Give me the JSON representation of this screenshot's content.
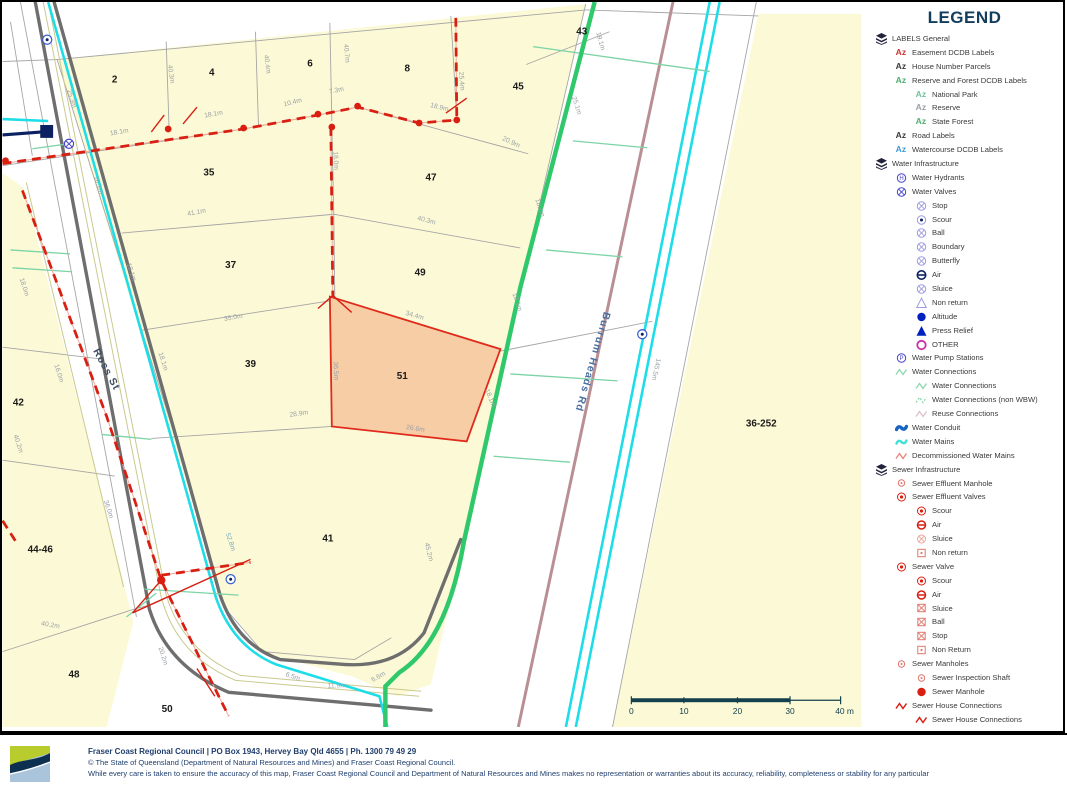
{
  "colors": {
    "parcel_fill": "#FCFAD6",
    "selected_parcel_fill": "#F6C9A2",
    "selected_parcel_border": "#E02A1C",
    "road_casing": "#6E6E6E",
    "water_main_cyan": "#1CDDE8",
    "water_green": "#2FC96B",
    "decom_brown": "#B98F93",
    "sewer_red": "#D81F12",
    "conduit_navy": "#0B2161",
    "valve_blue": "#4646C8",
    "valve_blue_light": "#9C9CE0",
    "magenta": "#CC2FA8",
    "dim_gray": "#9AA0A6",
    "scale_teal": "#15404D",
    "legend_title": "#123D5C",
    "footer_navy": "#1F3E6E"
  },
  "legend": {
    "title": "LEGEND",
    "items": [
      {
        "label": "LABELS General",
        "indent": 0,
        "icon": "layers-icon"
      },
      {
        "label": "Easement DCDB Labels",
        "indent": 1,
        "icon": "az-red-icon"
      },
      {
        "label": "House Number Parcels",
        "indent": 1,
        "icon": "az-dark-icon"
      },
      {
        "label": "Reserve and Forest DCDB Labels",
        "indent": 1,
        "icon": "az-green-icon"
      },
      {
        "label": "National Park",
        "indent": 2,
        "icon": "az-teal-icon"
      },
      {
        "label": "Reserve",
        "indent": 2,
        "icon": "az-gray-icon"
      },
      {
        "label": "State Forest",
        "indent": 2,
        "icon": "az-green-icon"
      },
      {
        "label": "Road Labels",
        "indent": 1,
        "icon": "az-dark-icon"
      },
      {
        "label": "Watercourse DCDB Labels",
        "indent": 1,
        "icon": "az-blue-icon"
      },
      {
        "label": "Water Infrastructure",
        "indent": 0,
        "icon": "layers-icon"
      },
      {
        "label": "Water Hydrants",
        "indent": 1,
        "icon": "circle-h-blue-icon"
      },
      {
        "label": "Water Valves",
        "indent": 1,
        "icon": "circle-x-blue-icon"
      },
      {
        "label": "Stop",
        "indent": 2,
        "icon": "circle-x-lightblue-icon"
      },
      {
        "label": "Scour",
        "indent": 2,
        "icon": "circle-dot-blue-icon"
      },
      {
        "label": "Ball",
        "indent": 2,
        "icon": "circle-x-lightblue-icon"
      },
      {
        "label": "Boundary",
        "indent": 2,
        "icon": "circle-x-lightblue-icon"
      },
      {
        "label": "Butterfly",
        "indent": 2,
        "icon": "circle-x-lightblue-icon"
      },
      {
        "label": "Air",
        "indent": 2,
        "icon": "circle-hbar-blue-icon"
      },
      {
        "label": "Sluice",
        "indent": 2,
        "icon": "circle-x-lightblue-icon"
      },
      {
        "label": "Non return",
        "indent": 2,
        "icon": "triangle-outline-icon"
      },
      {
        "label": "Altitude",
        "indent": 2,
        "icon": "circle-filled-blue-icon"
      },
      {
        "label": "Press Relief",
        "indent": 2,
        "icon": "triangle-filled-blue-icon"
      },
      {
        "label": "OTHER",
        "indent": 2,
        "icon": "circle-magenta-icon"
      },
      {
        "label": "Water Pump Stations",
        "indent": 1,
        "icon": "circle-p-blue-icon"
      },
      {
        "label": "Water Connections",
        "indent": 1,
        "icon": "zigzag-green-icon"
      },
      {
        "label": "Water Connections",
        "indent": 2,
        "icon": "zigzag-green-icon"
      },
      {
        "label": "Water Connections (non WBW)",
        "indent": 2,
        "icon": "zigzag-green-dashed-icon"
      },
      {
        "label": "Reuse Connections",
        "indent": 2,
        "icon": "zigzag-pink-icon"
      },
      {
        "label": "Water Conduit",
        "indent": 1,
        "icon": "wave-navy-icon"
      },
      {
        "label": "Water Mains",
        "indent": 1,
        "icon": "wave-cyan-icon"
      },
      {
        "label": "Decommissioned Water Mains",
        "indent": 1,
        "icon": "zigzag-salmon-icon"
      },
      {
        "label": "Sewer Infrastructure",
        "indent": 0,
        "icon": "layers-icon"
      },
      {
        "label": "Sewer Effluent Manhole",
        "indent": 1,
        "icon": "circle-dot-red-small-icon"
      },
      {
        "label": "Sewer Effluent Valves",
        "indent": 1,
        "icon": "circle-dot-red-icon"
      },
      {
        "label": "Scour",
        "indent": 2,
        "icon": "circle-dot-red-icon"
      },
      {
        "label": "Air",
        "indent": 2,
        "icon": "circle-hbar-red-icon"
      },
      {
        "label": "Sluice",
        "indent": 2,
        "icon": "circle-x-lightred-icon"
      },
      {
        "label": "Non return",
        "indent": 2,
        "icon": "square-dot-red-icon"
      },
      {
        "label": "Sewer Valve",
        "indent": 1,
        "icon": "circle-dot-red-icon"
      },
      {
        "label": "Scour",
        "indent": 2,
        "icon": "circle-dot-red-icon"
      },
      {
        "label": "Air",
        "indent": 2,
        "icon": "circle-hbar-red-icon"
      },
      {
        "label": "Sluice",
        "indent": 2,
        "icon": "square-x-red-icon"
      },
      {
        "label": "Ball",
        "indent": 2,
        "icon": "square-x-red-icon"
      },
      {
        "label": "Stop",
        "indent": 2,
        "icon": "square-x-red-icon"
      },
      {
        "label": "Non Return",
        "indent": 2,
        "icon": "square-dot-red-icon"
      },
      {
        "label": "Sewer Manholes",
        "indent": 1,
        "icon": "circle-dot-red-small-icon"
      },
      {
        "label": "Sewer Inspection Shaft",
        "indent": 2,
        "icon": "circle-dot-red-small-icon"
      },
      {
        "label": "Sewer Manhole",
        "indent": 2,
        "icon": "circle-filled-red-icon"
      },
      {
        "label": "Sewer House Connections",
        "indent": 1,
        "icon": "zigzag-red-icon"
      },
      {
        "label": "Sewer House Connections",
        "indent": 2,
        "icon": "zigzag-red-icon"
      }
    ]
  },
  "map": {
    "selected_parcel": "51",
    "labels": [
      {
        "t": "2",
        "x": 113,
        "y": 81,
        "r": 0,
        "k": "p"
      },
      {
        "t": "4",
        "x": 211,
        "y": 74,
        "r": 0,
        "k": "p"
      },
      {
        "t": "6",
        "x": 310,
        "y": 65,
        "r": 0,
        "k": "p"
      },
      {
        "t": "8",
        "x": 408,
        "y": 70,
        "r": 0,
        "k": "p"
      },
      {
        "t": "45",
        "x": 520,
        "y": 88,
        "r": 0,
        "k": "p"
      },
      {
        "t": "43",
        "x": 584,
        "y": 33,
        "r": 0,
        "k": "p"
      },
      {
        "t": "35",
        "x": 208,
        "y": 175,
        "r": 0,
        "k": "p"
      },
      {
        "t": "47",
        "x": 432,
        "y": 180,
        "r": 0,
        "k": "p"
      },
      {
        "t": "37",
        "x": 230,
        "y": 268,
        "r": 0,
        "k": "p"
      },
      {
        "t": "49",
        "x": 421,
        "y": 276,
        "r": 0,
        "k": "p"
      },
      {
        "t": "39",
        "x": 250,
        "y": 368,
        "r": 0,
        "k": "p"
      },
      {
        "t": "51",
        "x": 403,
        "y": 380,
        "r": 0,
        "k": "p"
      },
      {
        "t": "41",
        "x": 328,
        "y": 544,
        "r": 0,
        "k": "p"
      },
      {
        "t": "42",
        "x": 16,
        "y": 407,
        "r": 0,
        "k": "p"
      },
      {
        "t": "44-46",
        "x": 38,
        "y": 555,
        "r": 0,
        "k": "p"
      },
      {
        "t": "48",
        "x": 72,
        "y": 681,
        "r": 0,
        "k": "p"
      },
      {
        "t": "50",
        "x": 166,
        "y": 716,
        "r": 0,
        "k": "p"
      },
      {
        "t": "36-252",
        "x": 765,
        "y": 428,
        "r": 0,
        "k": "p"
      },
      {
        "t": "Ross St",
        "x": 102,
        "y": 372,
        "r": 62,
        "k": "road"
      },
      {
        "t": "Burrum Heads Rd",
        "x": 592,
        "y": 362,
        "r": 106,
        "k": "road2"
      },
      {
        "t": "25.3m",
        "x": 68,
        "y": 98,
        "r": 72,
        "k": "d"
      },
      {
        "t": "18.1m",
        "x": 95,
        "y": 185,
        "r": 72,
        "k": "d"
      },
      {
        "t": "18.1m",
        "x": 118,
        "y": 133,
        "r": -10,
        "k": "d"
      },
      {
        "t": "18.1m",
        "x": 213,
        "y": 115,
        "r": -10,
        "k": "d"
      },
      {
        "t": "40.3m",
        "x": 168,
        "y": 73,
        "r": 82,
        "k": "d"
      },
      {
        "t": "40.4m",
        "x": 265,
        "y": 63,
        "r": 83,
        "k": "d"
      },
      {
        "t": "40.7m",
        "x": 345,
        "y": 52,
        "r": 85,
        "k": "d"
      },
      {
        "t": "10.4m",
        "x": 293,
        "y": 103,
        "r": -14,
        "k": "d"
      },
      {
        "t": "7.3m",
        "x": 337,
        "y": 91,
        "r": -12,
        "k": "d"
      },
      {
        "t": "18.9m",
        "x": 440,
        "y": 108,
        "r": 14,
        "k": "d"
      },
      {
        "t": "25.4m",
        "x": 461,
        "y": 80,
        "r": 86,
        "k": "d"
      },
      {
        "t": "20.9m",
        "x": 512,
        "y": 143,
        "r": 25,
        "k": "d"
      },
      {
        "t": "19.1m",
        "x": 601,
        "y": 40,
        "r": 75,
        "k": "d"
      },
      {
        "t": "25.1m",
        "x": 577,
        "y": 105,
        "r": 72,
        "k": "d"
      },
      {
        "t": "18.1m",
        "x": 540,
        "y": 208,
        "r": 72,
        "k": "d"
      },
      {
        "t": "41.1m",
        "x": 196,
        "y": 214,
        "r": -11,
        "k": "d"
      },
      {
        "t": "40.3m",
        "x": 427,
        "y": 222,
        "r": 15,
        "k": "d"
      },
      {
        "t": "18.0m",
        "x": 334,
        "y": 160,
        "r": 88,
        "k": "d"
      },
      {
        "t": "18.0m",
        "x": 20,
        "y": 288,
        "r": 72,
        "k": "d"
      },
      {
        "t": "18.1m",
        "x": 128,
        "y": 273,
        "r": 72,
        "k": "d"
      },
      {
        "t": "16.0m",
        "x": 55,
        "y": 375,
        "r": 72,
        "k": "d"
      },
      {
        "t": "18.1m",
        "x": 160,
        "y": 363,
        "r": 72,
        "k": "d"
      },
      {
        "t": "35.0m",
        "x": 233,
        "y": 320,
        "r": -10,
        "k": "d"
      },
      {
        "t": "34.4m",
        "x": 415,
        "y": 318,
        "r": 16,
        "k": "d"
      },
      {
        "t": "36.5m",
        "x": 334,
        "y": 372,
        "r": 88,
        "k": "d"
      },
      {
        "t": "18.1m",
        "x": 517,
        "y": 303,
        "r": 72,
        "k": "d"
      },
      {
        "t": "18.1m",
        "x": 490,
        "y": 400,
        "r": 68,
        "k": "d"
      },
      {
        "t": "28.9m",
        "x": 299,
        "y": 417,
        "r": -8,
        "k": "d"
      },
      {
        "t": "26.6m",
        "x": 416,
        "y": 432,
        "r": 9,
        "k": "d"
      },
      {
        "t": "40.2m",
        "x": 14,
        "y": 446,
        "r": 72,
        "k": "d"
      },
      {
        "t": "36.0m",
        "x": 105,
        "y": 512,
        "r": 72,
        "k": "d"
      },
      {
        "t": "52.8m",
        "x": 228,
        "y": 545,
        "r": 72,
        "k": "db"
      },
      {
        "t": "40.2m",
        "x": 48,
        "y": 630,
        "r": 10,
        "k": "d"
      },
      {
        "t": "20.2m",
        "x": 160,
        "y": 660,
        "r": 72,
        "k": "d"
      },
      {
        "t": "45.2m",
        "x": 428,
        "y": 555,
        "r": 76,
        "k": "d"
      },
      {
        "t": "6.5m",
        "x": 292,
        "y": 682,
        "r": 20,
        "k": "d"
      },
      {
        "t": "11.9m",
        "x": 337,
        "y": 691,
        "r": 0,
        "k": "d"
      },
      {
        "t": "6.6m",
        "x": 380,
        "y": 682,
        "r": -30,
        "k": "d"
      },
      {
        "t": "145.5m",
        "x": 657,
        "y": 370,
        "r": 102,
        "k": "d"
      }
    ],
    "scale_bar": {
      "tick_labels": [
        "0",
        "10",
        "20",
        "30"
      ],
      "tick_x": [
        634,
        687,
        741,
        794
      ],
      "end_label": "40 m",
      "end_x": 849
    }
  },
  "footer": {
    "line1": "Fraser Coast Regional Council | PO Box 1943, Hervey Bay Qld 4655 | Ph. 1300 79 49 29",
    "line2": "© The State of Queensland (Department of Natural Resources and Mines) and Fraser Coast Regional Council.",
    "line3": "While every care is taken to ensure the accuracy of this map, Fraser Coast Regional Council and Department of Natural Resources and Mines makes no representation or warranties about its accuracy, reliability, completeness or stability for any particular"
  }
}
